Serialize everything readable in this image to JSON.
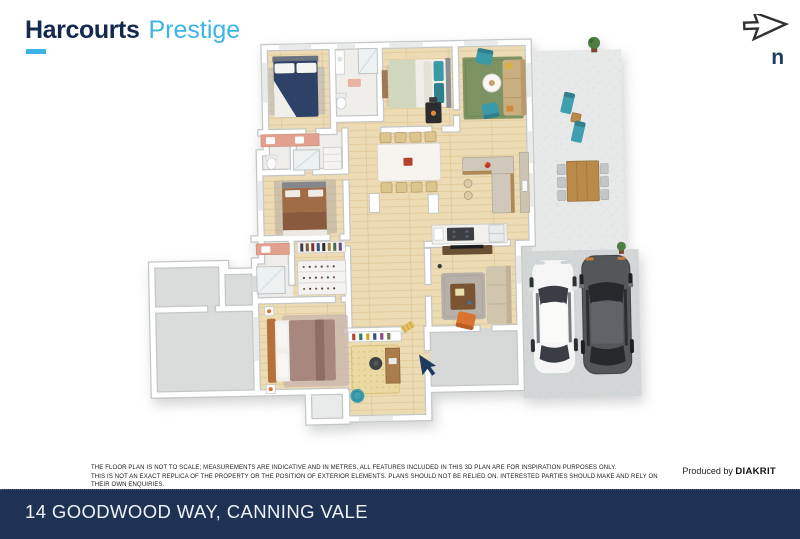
{
  "brand": {
    "name": "Harcourts",
    "suffix": "Prestige"
  },
  "north_indicator": {
    "label": "n"
  },
  "floorplan": {
    "alt": "3D floor plan render of single-storey house with alfresco patio, outdoor dining, double driveway with two cars, garage wing and entry arrow"
  },
  "disclaimer": {
    "line1": "THE FLOOR PLAN IS NOT TO SCALE; MEASUREMENTS ARE INDICATIVE AND IN METRES. ALL FEATURES INCLUDED IN THIS 3D PLAN ARE FOR INSPIRATION PURPOSES ONLY.",
    "line2": "THIS IS NOT AN EXACT REPLICA OF THE PROPERTY OR THE POSITION OF EXTERIOR ELEMENTS. PLANS SHOULD NOT BE RELIED ON. INTERESTED PARTIES SHOULD MAKE AND RELY ON THEIR OWN ENQUIRIES."
  },
  "credit": {
    "prefix": "Produced by ",
    "producer": "DIAKRIT"
  },
  "footer": {
    "address": "14 GOODWOOD WAY, CANNING VALE"
  },
  "colors": {
    "brand_navy": "#14294e",
    "brand_cyan": "#3cb4e5",
    "footer_navy": "#1e3354",
    "arrow_navy": "#1d3a5f"
  }
}
